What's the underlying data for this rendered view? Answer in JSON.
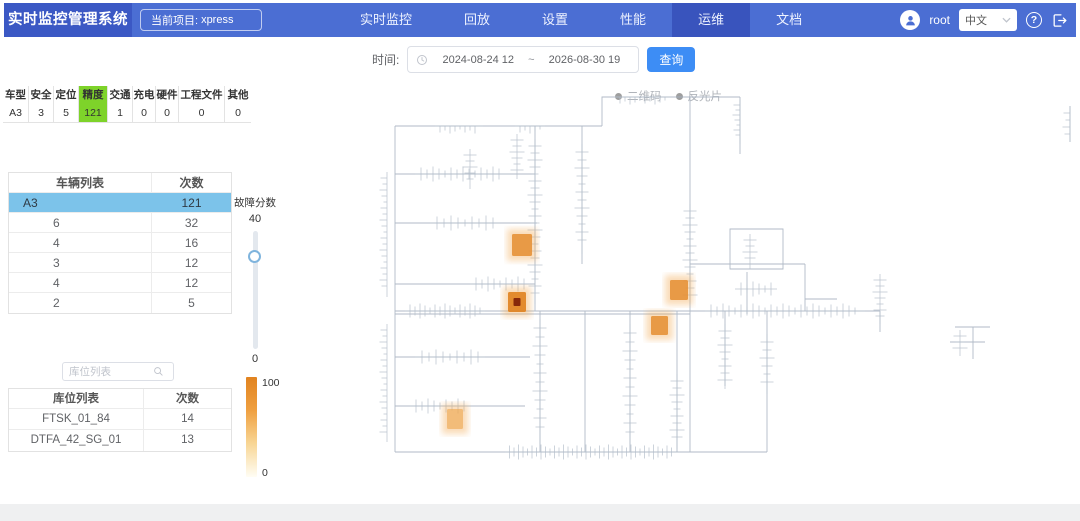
{
  "app": {
    "title": "实时监控管理系统",
    "project_label": "当前项目:",
    "project_value": "xpress"
  },
  "nav": {
    "items": [
      {
        "label": "实时监控",
        "active": false
      },
      {
        "label": "回放",
        "active": false
      },
      {
        "label": "设置",
        "active": false
      },
      {
        "label": "性能",
        "active": false
      },
      {
        "label": "运维",
        "active": true
      },
      {
        "label": "文档",
        "active": false
      }
    ]
  },
  "user": {
    "name": "root",
    "language": "中文"
  },
  "query_bar": {
    "time_label": "时间:",
    "start": "2024-08-24 12",
    "separator": "~",
    "end": "2026-08-30 19",
    "search_button": "查询"
  },
  "stats": {
    "columns": [
      "车型",
      "安全",
      "定位",
      "精度",
      "交通",
      "充电",
      "硬件",
      "工程文件",
      "其他"
    ],
    "values": [
      "A3",
      "3",
      "5",
      "121",
      "1",
      "0",
      "0",
      "0",
      "0"
    ],
    "highlight_index": 3,
    "highlight_color": "#7ed32a",
    "col_widths": [
      26,
      25,
      25,
      29,
      25,
      23,
      23,
      46,
      26
    ]
  },
  "vehicle_table": {
    "headers": [
      "车辆列表",
      "次数"
    ],
    "rows": [
      {
        "name": "A3",
        "count": "121",
        "selected": true,
        "child": false
      },
      {
        "name": "6",
        "count": "32",
        "selected": false,
        "child": true
      },
      {
        "name": "4",
        "count": "16",
        "selected": false,
        "child": true
      },
      {
        "name": "3",
        "count": "12",
        "selected": false,
        "child": true
      },
      {
        "name": "4",
        "count": "12",
        "selected": false,
        "child": true
      },
      {
        "name": "2",
        "count": "5",
        "selected": false,
        "child": true
      }
    ]
  },
  "fault_slider": {
    "label": "故障分数",
    "top_value": "40",
    "bottom_value": "0",
    "handle_pct": 16
  },
  "storage_search": {
    "placeholder": "库位列表"
  },
  "storage_table": {
    "headers": [
      "库位列表",
      "次数"
    ],
    "rows": [
      {
        "name": "FTSK_01_84",
        "count": "14"
      },
      {
        "name": "DTFA_42_SG_01",
        "count": "13"
      }
    ]
  },
  "heat_legend": {
    "max": "100",
    "min": "0",
    "colors": [
      "#e1831f",
      "#efa041",
      "#f8d695",
      "#fffdf4"
    ]
  },
  "map": {
    "legend": [
      {
        "label": "二维码",
        "name": "legend-item-qrcode"
      },
      {
        "label": "反光片",
        "name": "legend-item-reflector"
      }
    ],
    "heat_points": [
      {
        "x": 137,
        "y": 150,
        "w": 20,
        "h": 22,
        "tone": "mid",
        "core": false
      },
      {
        "x": 133,
        "y": 208,
        "w": 18,
        "h": 20,
        "tone": "hot",
        "core": true
      },
      {
        "x": 295,
        "y": 196,
        "w": 18,
        "h": 20,
        "tone": "mid",
        "core": false
      },
      {
        "x": 276,
        "y": 232,
        "w": 17,
        "h": 19,
        "tone": "mid",
        "core": false
      },
      {
        "x": 72,
        "y": 325,
        "w": 16,
        "h": 20,
        "tone": "soft",
        "core": false
      }
    ]
  }
}
